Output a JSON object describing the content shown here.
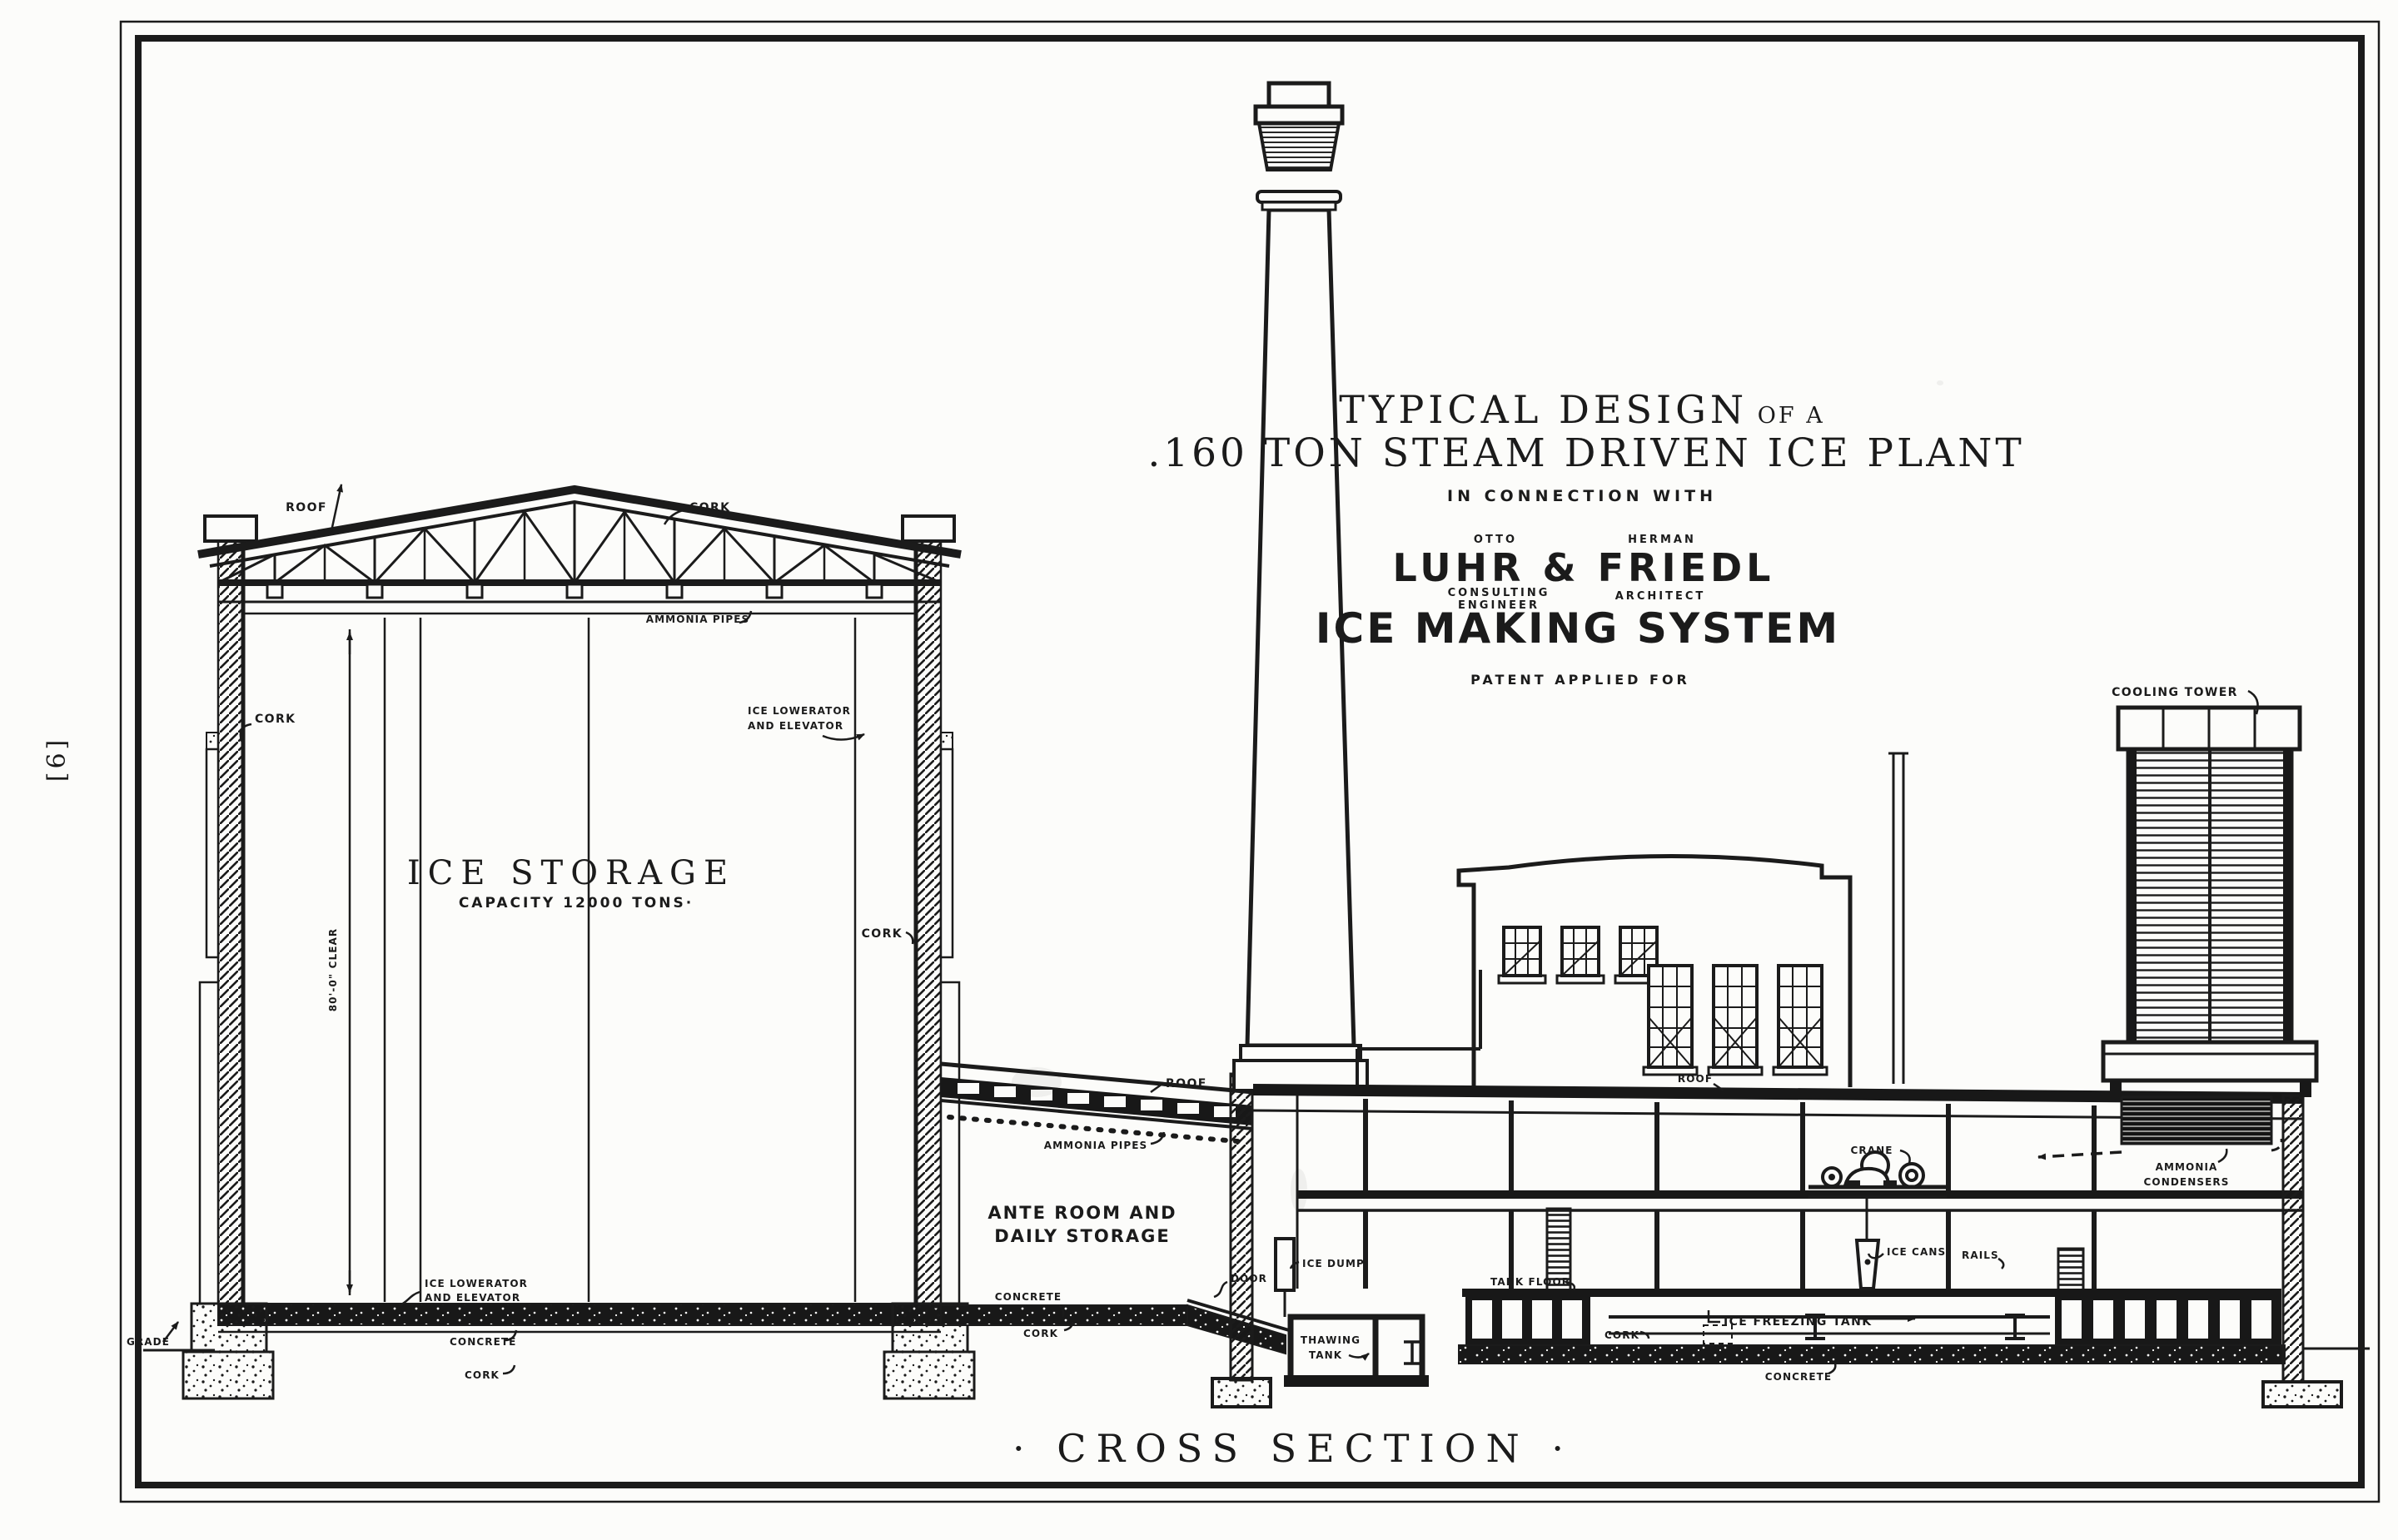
{
  "page": {
    "number": "[6]",
    "caption": "· CROSS SECTION ·"
  },
  "colors": {
    "ink": "#1b1b1b",
    "paper": "#fcfcfa"
  },
  "title_block": {
    "line1": "TYPICAL DESIGN",
    "line1_suffix": " OF A",
    "line2": ".160 TON STEAM DRIVEN ICE PLANT",
    "line3": "IN CONNECTION WITH",
    "name1_over": "OTTO",
    "name2_over": "HERMAN",
    "firm": "LUHR & FRIEDL",
    "role1a": "CONSULTING",
    "role1b": "ENGINEER",
    "role2": "ARCHITECT",
    "system": "ICE MAKING SYSTEM",
    "patent": "PATENT APPLIED FOR"
  },
  "ice_storage": {
    "title": "ICE STORAGE",
    "capacity": "CAPACITY 12000 TONS·",
    "roof": "ROOF",
    "cork_top": "CORK",
    "ammonia_pipes": "AMMONIA PIPES",
    "cork_left": "CORK",
    "clear_height": "80'-0\" CLEAR",
    "lowerator_right_1": "ICE LOWERATOR",
    "lowerator_right_2": "AND ELEVATOR",
    "cork_right": "CORK",
    "lowerator_bottom_1": "ICE LOWERATOR",
    "lowerator_bottom_2": "AND ELEVATOR",
    "grade": "GRADE",
    "concrete": "CONCRETE",
    "cork_bottom": "CORK"
  },
  "ante_room": {
    "roof": "ROOF",
    "ammonia_pipes": "AMMONIA PIPES",
    "name_line1": "ANTE ROOM AND",
    "name_line2": "DAILY STORAGE",
    "concrete": "CONCRETE",
    "cork": "CORK",
    "door": "DOOR",
    "ice_dump": "ICE DUMP",
    "thawing_line1": "THAWING",
    "thawing_line2": "TANK"
  },
  "plant": {
    "roof": "ROOF",
    "crane": "CRANE",
    "ice_cans": "ICE CANS",
    "rails": "RAILS",
    "tank_floor": "TANK FLOOR",
    "cork": "CORK",
    "ice_freezing_tank": "ICE FREEZING TANK",
    "concrete": "CONCRETE",
    "ammonia_condensers_1": "AMMONIA",
    "ammonia_condensers_2": "CONDENSERS",
    "cooling_tower": "COOLING TOWER"
  }
}
